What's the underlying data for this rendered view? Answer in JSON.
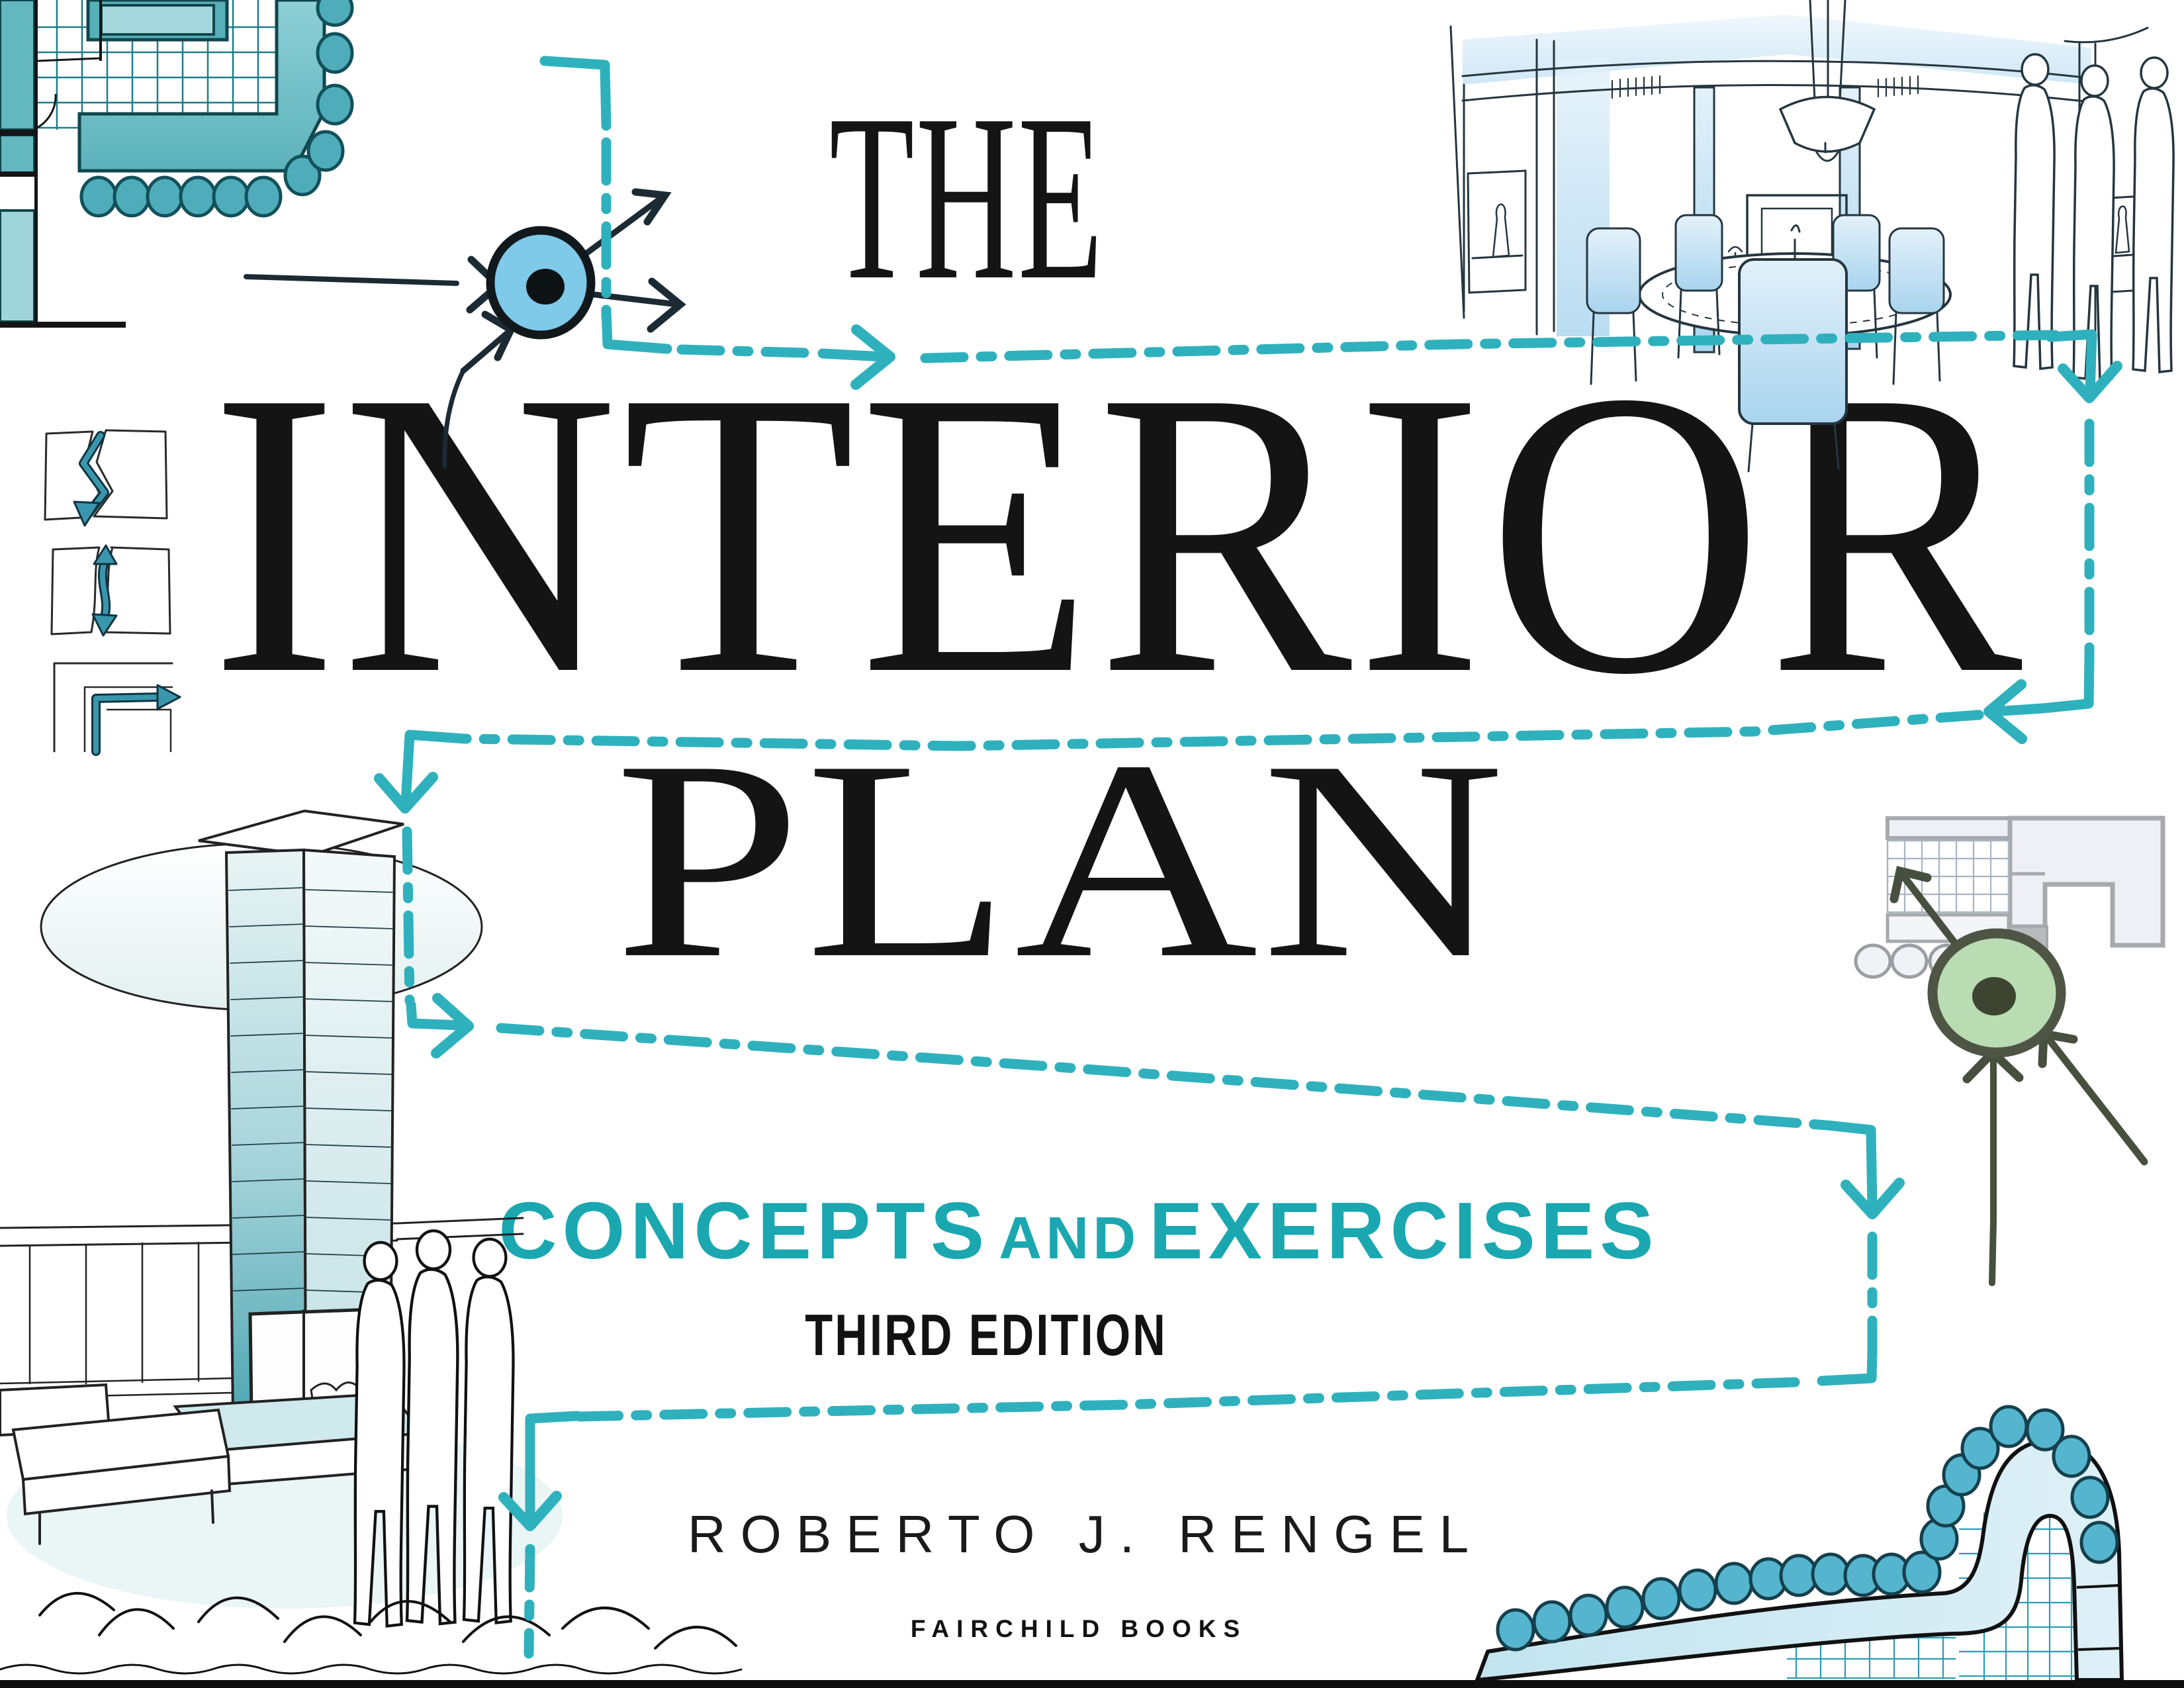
{
  "cover": {
    "title_line1": "THE",
    "title_line2": "INTERIOR",
    "title_line3": "PLAN",
    "subtitle": {
      "part1": "CONCEPTS",
      "and": "AND",
      "part2": "EXERCISES"
    },
    "edition": "THIRD EDITION",
    "author": "ROBERTO J. RENGEL",
    "publisher": "FAIRCHILD BOOKS"
  },
  "colors": {
    "path_teal": "#2fb1bd",
    "subtitle_teal": "#1ba7b0",
    "title_black": "#141414",
    "plan_fill_teal": "#63b7bf",
    "plan_fill_light": "#9fd4d9",
    "plan_outline_dark": "#10464d",
    "node_blue": "#7fc9e9",
    "node_green": "#b9dcb2",
    "olive_arrow": "#47503f",
    "sketch_ink": "#25363f",
    "wall_gray": "#a7a9ad",
    "banquette_blue": "#cde8f2",
    "dot_teal": "#55b5ce"
  },
  "illustrations": {
    "top_left": "floor-plan-sketch-icon",
    "top_left_node": "blue-circulation-node-icon",
    "top_right": "dining-room-sketch-icon",
    "left_column": "circulation-concept-diagram-icons",
    "bottom_left": "fireplace-lounge-sketch-icon",
    "right_middle": "gray-floor-plan-sketch-icon",
    "right_node": "green-circulation-node-icon",
    "bottom_right": "curved-banquette-sketch-icon",
    "overlay": "teal-dashed-circulation-path"
  }
}
